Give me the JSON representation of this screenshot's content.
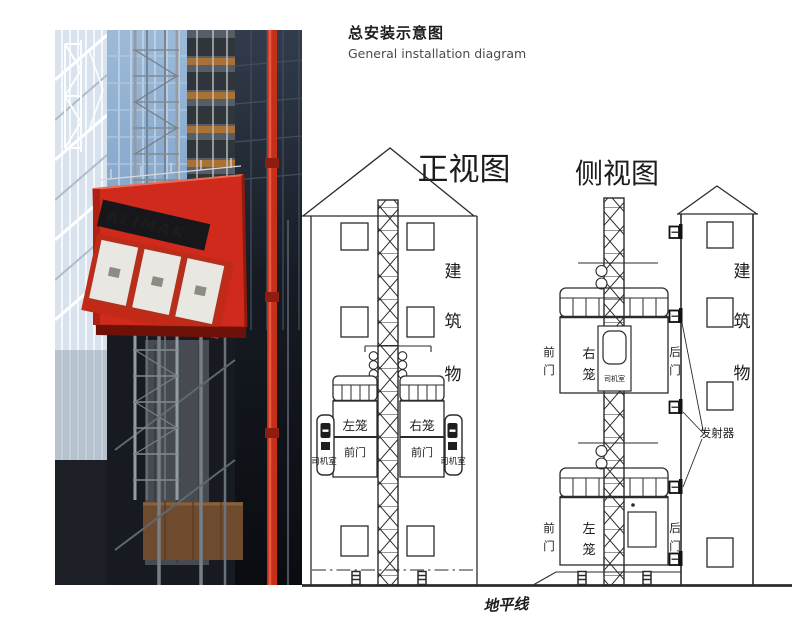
{
  "header": {
    "title_zh": "总安装示意图",
    "title_en": "General installation diagram"
  },
  "photo": {
    "brand": "ALIMAK"
  },
  "front_view": {
    "title": "正视图",
    "building_chars": [
      "建",
      "筑",
      "物"
    ],
    "left_cage": "左笼",
    "right_cage": "右笼",
    "front_door": "前门",
    "driver_cab": "司机室"
  },
  "side_view": {
    "title": "侧视图",
    "building_chars": [
      "建",
      "筑",
      "物"
    ],
    "upper_cage_chars": [
      "右",
      "笼"
    ],
    "lower_cage_chars": [
      "左",
      "笼"
    ],
    "front_door_chars": [
      "前",
      "门"
    ],
    "rear_door_chars": [
      "后",
      "门"
    ],
    "driver_cab": "司机室",
    "transmitter_label": "发射器"
  },
  "ground_label": "地平线",
  "colors": {
    "diagram_line": "#2b2b2b",
    "brand_red": "#cf2a1b",
    "glass_blue": "#8fafd0",
    "dark_building": "#14171d"
  }
}
